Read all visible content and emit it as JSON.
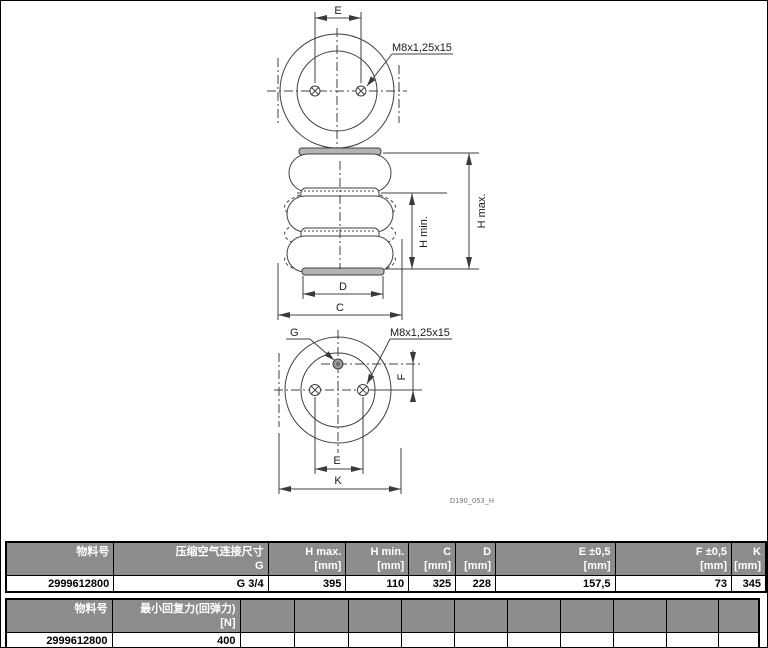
{
  "page": {
    "background": "#ffffff",
    "border_color": "#000000"
  },
  "drawing": {
    "labels": {
      "dim_e": "E",
      "dim_c": "C",
      "dim_d": "D",
      "dim_f": "F",
      "dim_k": "K",
      "dim_h_min": "H min.",
      "dim_h_max": "H max.",
      "thread": "M8x1,25x15",
      "air_port": "G",
      "drawing_id": "D190_053_H"
    }
  },
  "tables": {
    "dimensions": {
      "headers": [
        {
          "l1": "物料号",
          "l2": ""
        },
        {
          "l1": "压缩空气连接尺寸",
          "l2": "G"
        },
        {
          "l1": "H max.",
          "l2": "[mm]"
        },
        {
          "l1": "H min.",
          "l2": "[mm]"
        },
        {
          "l1": "C",
          "l2": "[mm]"
        },
        {
          "l1": "D",
          "l2": "[mm]"
        },
        {
          "l1": "E ±0,5",
          "l2": "[mm]"
        },
        {
          "l1": "F ±0,5",
          "l2": "[mm]"
        },
        {
          "l1": "K",
          "l2": "[mm]"
        }
      ],
      "rows": [
        [
          "2999612800",
          "G 3/4",
          "395",
          "110",
          "325",
          "228",
          "157,5",
          "73",
          "345"
        ]
      ]
    },
    "rebound": {
      "headers": [
        {
          "l1": "物料号",
          "l2": ""
        },
        {
          "l1": "最小回复力(回弹力)",
          "l2": "[N]"
        },
        {},
        {},
        {},
        {},
        {},
        {},
        {},
        {},
        {},
        {}
      ],
      "rows": [
        [
          "2999612800",
          "400",
          "",
          "",
          "",
          "",
          "",
          "",
          "",
          "",
          "",
          ""
        ]
      ]
    }
  },
  "colors": {
    "table_header_bg": "#8c8c8c",
    "table_header_text": "#ffffff",
    "table_body_text": "#000000",
    "drawing_line": "#404040",
    "plate_fill": "#b4b4b4"
  }
}
